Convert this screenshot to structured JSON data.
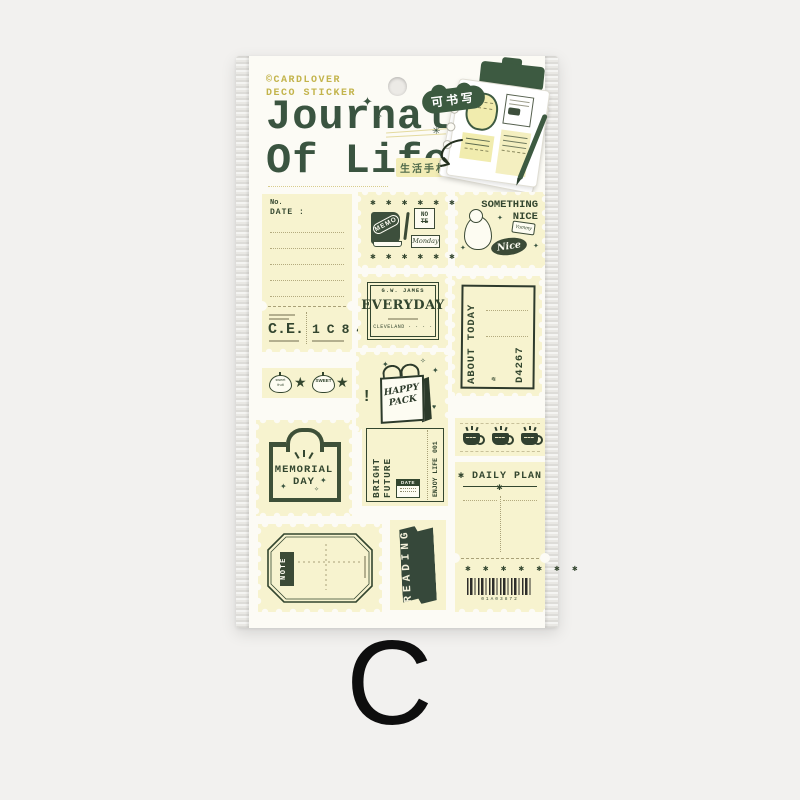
{
  "colors": {
    "background": "#f2f1ef",
    "sheet": "#fcfbf5",
    "sticker_cream": "#f7f3cf",
    "ink_green": "#33462f",
    "dark_green": "#3c5a40",
    "brand_olive": "#c3b44c",
    "badge_yellow": "#f2ecb5"
  },
  "icons": {
    "sparkle": "✦",
    "sparkle_small": "✧",
    "burst": "✳",
    "asterisk": "✱",
    "star": "★",
    "heart": "♥",
    "bang": "!",
    "number_sign": "№"
  },
  "header": {
    "brand_line1": "©CARDLOVER",
    "brand_line2": "DECO STICKER",
    "title_line1": "Journal",
    "title_line2": "Of Life",
    "writable_badge": "可书写",
    "subtitle_badge": "生活手札"
  },
  "variant_letter": "C",
  "stickers": {
    "note_ticket": {
      "no_label": "No.",
      "date_label": "DATE :",
      "code": "C.E.",
      "digits": "1C84"
    },
    "memo": {
      "book": "MEMO",
      "pad_line1": "NO",
      "pad_line2": "TE",
      "day": "Monday",
      "stars": "✱ ✱ ✱ ✱ ✱ ✱ ✱"
    },
    "nice": {
      "line1": "SOMETHING",
      "line2": "NICE",
      "oval": "Nice",
      "bottle": "Yummy"
    },
    "everyday": {
      "top": "G.W. JAMES",
      "main": "EVERYDAY",
      "bottom": "CLEVELAND · · · ·"
    },
    "about": {
      "title": "ABOUT TODAY",
      "no_mark": "№",
      "code": "D4267"
    },
    "fruit": {
      "label1_line1": "sweet",
      "label1_line2": "fruit",
      "label2": "SWEET"
    },
    "happy": {
      "line1": "HAPPY",
      "line2": "PACK"
    },
    "memorial": {
      "line1": "MEMORIAL",
      "line2": "DAY"
    },
    "bright": {
      "side": "BRIGHT FUTURE",
      "right_top": "001",
      "right_bottom": "ENJOY LIFE",
      "date_label": "DATE"
    },
    "daily": {
      "title": "DAILY PLAN",
      "stars_row": "✱ ✱ ✱ ✱ ✱ ✱ ✱",
      "barcode_number": "01A03872"
    },
    "octagon": {
      "ribbon": "NOTE"
    },
    "reading": {
      "banner": "READING"
    }
  }
}
